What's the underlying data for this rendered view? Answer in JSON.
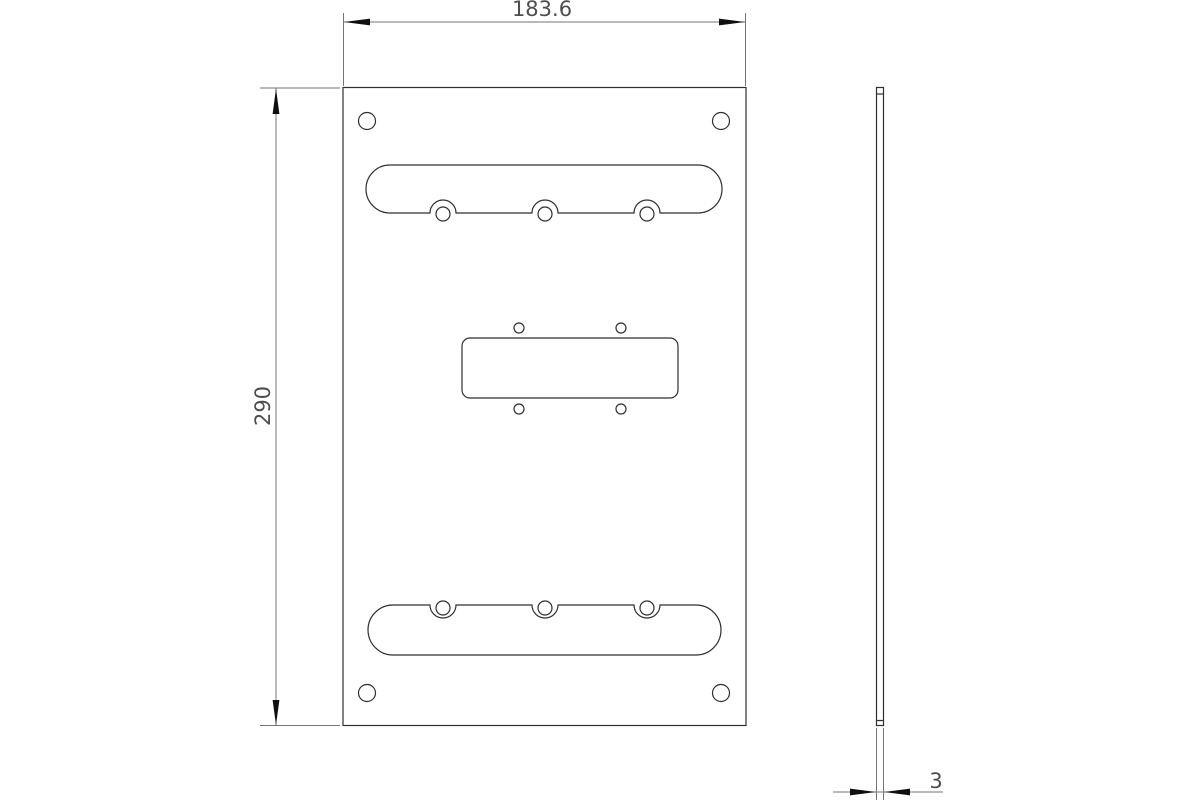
{
  "drawing": {
    "type": "technical-drawing",
    "views": {
      "front_view": "plate front view with mounting holes, two slotted cutouts and center cutout",
      "side_view": "plate thickness profile"
    },
    "dimensions": {
      "width_label": "183.6",
      "height_label": "290",
      "thickness_label": "3"
    },
    "colors": {
      "background": "#ffffff",
      "outline": "#2f2f2f",
      "dimension_lines": "#757575",
      "arrows": "#0f0f0f",
      "dimension_text": "#4d4d4d"
    }
  }
}
